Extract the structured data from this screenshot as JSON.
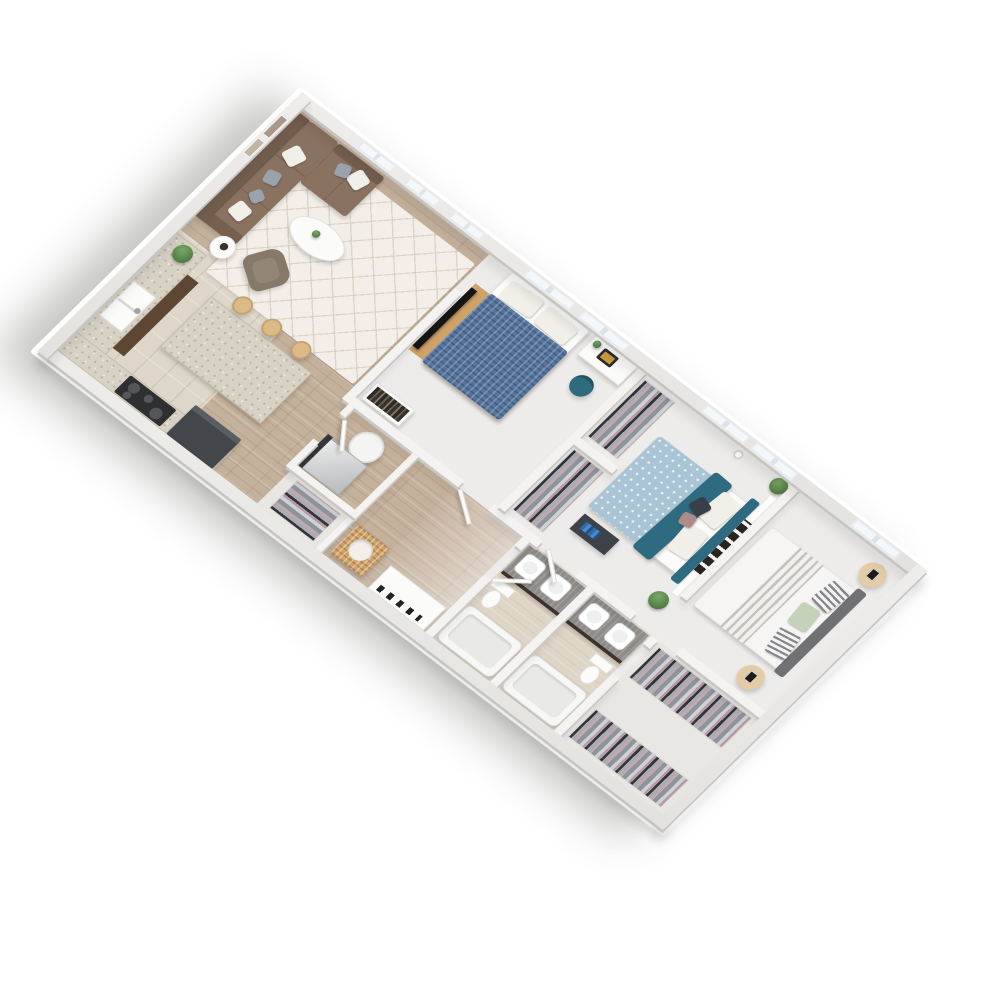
{
  "scene": {
    "type": "isometric-3d-floorplan-render",
    "subject": "three-bedroom two-bath apartment unit, furnished, viewed top-down at a rotated angle",
    "background_color": "#ffffff",
    "visible_text": "none"
  },
  "palette": {
    "wall": "#f4f3f1",
    "wall_shade": "#c9c8c5",
    "wood": "#c4b19c",
    "tile": "#ddd6c9",
    "room_floor": "#edecea",
    "bath_floor": "#dfd5c6",
    "closet_floor": "#e9e7e3",
    "rug": "#f3efe8",
    "sofa": "#8a7260",
    "sofa_dark": "#75604f",
    "armchair": "#87796a",
    "granite": "#d8d2c5",
    "cabinet_dark": "#5d4632",
    "appliance": "#43464a",
    "cooktop": "#2e2f31",
    "steel": "#c9ccce",
    "bed1": "#56749c",
    "bed2": "#a9c5d5",
    "teal": "#2f6b80",
    "bed3": "#f6f5f3",
    "sage": "#c3d2b8",
    "hb_gray": "#6f7174",
    "wood_accent": "#cfa268",
    "vanity_top": "#8e8c89",
    "plant": "#5d8a50",
    "window": "#f5f8fa"
  },
  "rooms": [
    {
      "name": "living-room",
      "floor": "hardwood",
      "furniture": [
        "brown L-sectional sofa",
        "white and gray throw pillows",
        "cream diamond-pattern area rug",
        "white oval coffee table with small plant",
        "round white side table with dark vase",
        "brown armchair",
        "two wall frames"
      ]
    },
    {
      "name": "kitchen",
      "floor": "tile",
      "furniture": [
        "L-shaped counter",
        "double-basin sink",
        "black cooktop with four burners",
        "dark refrigerator",
        "dark lower cabinets",
        "granite island",
        "three wood bar stools",
        "potted plant on counter"
      ]
    },
    {
      "name": "bedroom-1",
      "floor": "light",
      "furniture": [
        "double bed with blue denim duvet and white pillows",
        "flat-screen TV on wood stand",
        "white desk with laptop",
        "teal desk chair",
        "low bookshelf with books"
      ]
    },
    {
      "name": "bedroom-2",
      "floor": "light",
      "furniture": [
        "double bed with light-blue dotted duvet and teal throw",
        "teal upholstered headboard",
        "white storage wall with dark book cubbies",
        "dark bedside bench with blue books",
        "two potted plants",
        "white pendant lamp",
        "two open closets with hanging clothes"
      ]
    },
    {
      "name": "bedroom-3",
      "floor": "light",
      "furniture": [
        "double bed with white duvet and gray striped throw",
        "gray upholstered headboard",
        "striped and sage-green pillows",
        "two round wood nightstands with picture frames"
      ]
    },
    {
      "name": "bathroom-1",
      "floor": "washed-wood",
      "furniture": [
        "gray-wood double vanity with two white vessel sinks",
        "bathtub",
        "toilet"
      ]
    },
    {
      "name": "bathroom-2",
      "floor": "washed-wood",
      "furniture": [
        "gray-wood double vanity with two white vessel sinks",
        "bathtub",
        "toilet"
      ]
    },
    {
      "name": "utility-room",
      "floor": "hardwood",
      "furniture": [
        "stainless appliance cube",
        "white cylindrical laundry basket",
        "dark side panel"
      ]
    },
    {
      "name": "hallway",
      "floor": "hardwood",
      "furniture": [
        "wood laundry hamper with white towels",
        "white linen counter with dark accessories",
        "open closet with hanging clothes",
        "open door leaves"
      ]
    },
    {
      "name": "walk-in-closet",
      "floor": "light",
      "furniture": [
        "two long rails of hanging clothes in gray, pink and black"
      ]
    }
  ],
  "windows": {
    "top_wall_count": 8,
    "positions": "three at living room, two at bedroom-1, two at bedroom-2, one at bedroom-3"
  },
  "doors": {
    "open_doorways": 6,
    "visible_door_leaves": 4
  }
}
